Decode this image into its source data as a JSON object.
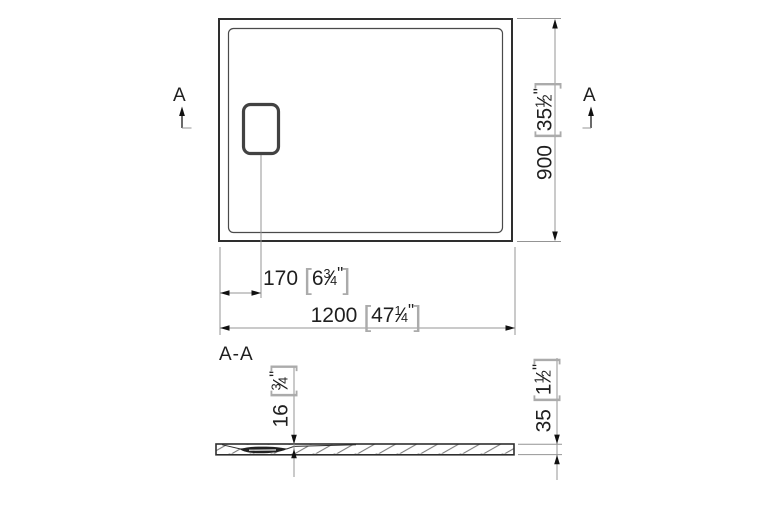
{
  "symbols": {
    "open_bracket": "[",
    "close_bracket": "]",
    "inch_mark": "\"",
    "fraction_slash": "⁄"
  },
  "top_view": {
    "section_marker_left": "A",
    "section_marker_right": "A",
    "dim_width": {
      "mm": "1200",
      "inch_whole": "47",
      "inch_numerator": "1",
      "inch_denominator": "4"
    },
    "dim_height": {
      "mm": "900",
      "inch_whole": "35",
      "inch_numerator": "1",
      "inch_denominator": "2"
    },
    "dim_drain_offset": {
      "mm": "170",
      "inch_whole": "6",
      "inch_numerator": "3",
      "inch_denominator": "4"
    }
  },
  "section_view": {
    "label": "A-A",
    "dim_depth": {
      "mm": "16",
      "inch_whole": "",
      "inch_numerator": "3",
      "inch_denominator": "4"
    },
    "dim_thickness": {
      "mm": "35",
      "inch_whole": "1",
      "inch_numerator": "1",
      "inch_denominator": "2"
    }
  },
  "colors": {
    "outline": "#2e2e2e",
    "dimension_line": "#949494",
    "text": "#1f1f1f",
    "bracket": "#ababab",
    "hatch": "#6e6e6e",
    "drain_fill": "#222222"
  }
}
